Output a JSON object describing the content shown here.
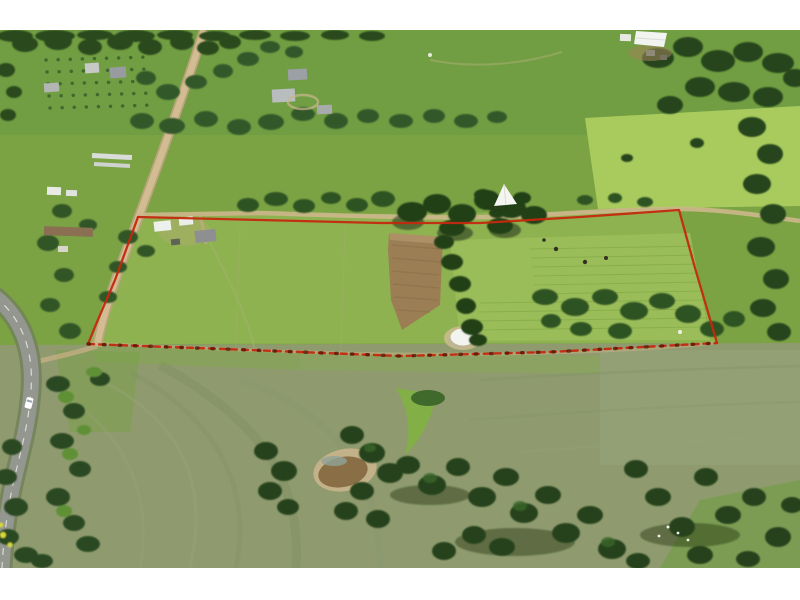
{
  "scene": {
    "type": "aerial-photograph",
    "subject": "rural acreage for sale, marked with a red property boundary overlay",
    "features": [
      "red boundary outline (solid sides, dashed lower fence line)",
      "sealed bitumen road lower-left with white car",
      "gravel road running from top edge down the left side of the parcel",
      "homestead and sheds inside north-west corner of parcel",
      "neighbouring farm buildings along top of frame",
      "brown ploughed paddock inside parcel",
      "white domed structure among trees on north track",
      "white-covered dam inside southern fence line",
      "muddy farm dam below parcel",
      "tree lines, shelter belts and scattered eucalypts",
      "green pastures and grey-green cropped fields",
      "orchard rows top-left",
      "livestock dots in eastern paddock",
      "white photo border top and bottom"
    ]
  },
  "colors": {
    "frame_white": "#ffffff",
    "boundary": "#c4290e",
    "boundary_post": "#5a1505",
    "field_base": "#7ba344",
    "field_top": "#719e42",
    "field_lime": "#a9cb5e",
    "field_parcel": "#8fb251",
    "field_parcel_light": "#9cbe5b",
    "field_olive": "#8f9b6f",
    "tree_dark": "#27451b",
    "tree_mid": "#2f5322",
    "sealed_road": "#94978f",
    "dirt_road": "#d2bd92",
    "paddock_brown": "#9c7e55",
    "pond_water": "#8a6f46",
    "pond_bank": "#c3b189",
    "gully_green": "#82b143",
    "dome_white": "#f3f4ef",
    "building_white": "#eef0ec",
    "building_gray": "#9aa0a4",
    "building_brown": "#8a6f52",
    "car_white": "#ffffff",
    "gorse_yellow": "#d4d83e"
  }
}
